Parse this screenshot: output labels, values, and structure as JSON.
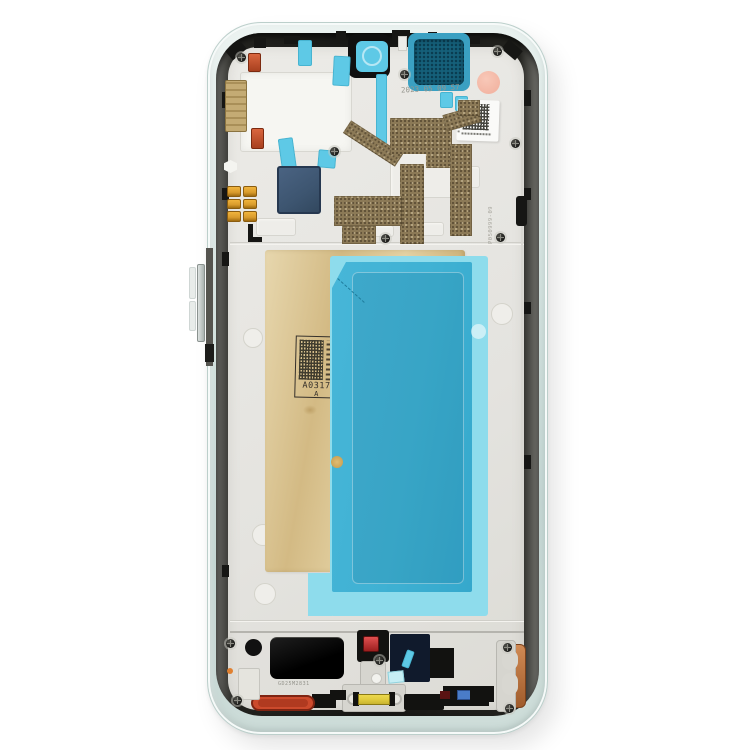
{
  "labels": {
    "date_code": "2023 05 09 57",
    "stamp_code": "A0317",
    "stamp_suffix": "A",
    "right_etch_code": "P050999-09",
    "speaker_etch_code": "GD25M2831"
  },
  "colors": {
    "frame_mint": "#d3e2df",
    "teal_film": "#3fb1d3",
    "teal_film_border": "#8edcec",
    "gold_sticker": "#d3ba84",
    "copper_flex": "#8c7a57",
    "earpiece_mesh": "#15607a",
    "pink_sticker": "#f3b6a4",
    "cyan_tape": "#5ec9e6",
    "red_gasket": "#cc4a2c",
    "yellow_connector": "#e0cb3e",
    "navy_module": "#101a2c",
    "slate_module": "#3d5570",
    "gold_contact": "#c4ab74",
    "gold_spring": "#d99b2c"
  }
}
